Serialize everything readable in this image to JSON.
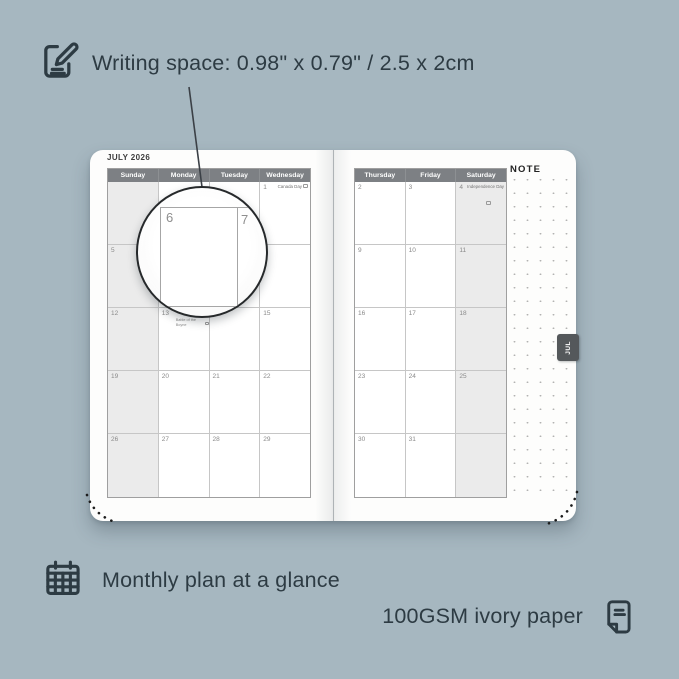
{
  "colors": {
    "background": "#a6b7c0",
    "ink": "#2d3b43",
    "page": "#fdfdfc",
    "weekday_header_bg": "#7d8084",
    "weekday_header_text": "#ffffff",
    "shaded_column_bg": "#ebebeb",
    "tab_bg": "#54585b",
    "tab_text": "#ffffff"
  },
  "annotations": {
    "writing_space": "Writing space: 0.98\" x 0.79\" / 2.5 x 2cm",
    "monthly_plan": "Monthly plan at a glance",
    "paper": "100GSM ivory paper"
  },
  "icons": {
    "top_left": "pencil-note-icon",
    "bottom_left": "calendar-grid-icon",
    "bottom_right": "paper-sheet-icon"
  },
  "planner": {
    "month_title": "JULY 2026",
    "tab_label": "JUL",
    "note_label": "NOTE",
    "magnifier": {
      "day_left": "6",
      "day_right": "7"
    },
    "left_page": {
      "headers": [
        "Sunday",
        "Monday",
        "Tuesday",
        "Wednesday"
      ],
      "shaded_column": 0,
      "rows": [
        [
          {
            "day": ""
          },
          {
            "day": ""
          },
          {
            "day": ""
          },
          {
            "day": "1",
            "holiday": "Canada Day",
            "flag": true,
            "layout": "inline"
          }
        ],
        [
          {
            "day": "5"
          },
          {
            "day": "6"
          },
          {
            "day": "7"
          },
          {
            "day": "8"
          }
        ],
        [
          {
            "day": "12"
          },
          {
            "day": "13",
            "holiday": "Battle of the Boyne",
            "flag": true,
            "layout": "below"
          },
          {
            "day": "14"
          },
          {
            "day": "15"
          }
        ],
        [
          {
            "day": "19"
          },
          {
            "day": "20"
          },
          {
            "day": "21"
          },
          {
            "day": "22"
          }
        ],
        [
          {
            "day": "26"
          },
          {
            "day": "27"
          },
          {
            "day": "28"
          },
          {
            "day": "29"
          }
        ]
      ]
    },
    "right_page": {
      "headers": [
        "Thursday",
        "Friday",
        "Saturday"
      ],
      "shaded_column": 2,
      "rows": [
        [
          {
            "day": "2"
          },
          {
            "day": "3"
          },
          {
            "day": "4",
            "holiday": "Independence Day",
            "flag": true,
            "layout": "stacked"
          }
        ],
        [
          {
            "day": "9"
          },
          {
            "day": "10"
          },
          {
            "day": "11"
          }
        ],
        [
          {
            "day": "16"
          },
          {
            "day": "17"
          },
          {
            "day": "18"
          }
        ],
        [
          {
            "day": "23"
          },
          {
            "day": "24"
          },
          {
            "day": "25"
          }
        ],
        [
          {
            "day": "30"
          },
          {
            "day": "31"
          },
          {
            "day": ""
          }
        ]
      ]
    }
  }
}
